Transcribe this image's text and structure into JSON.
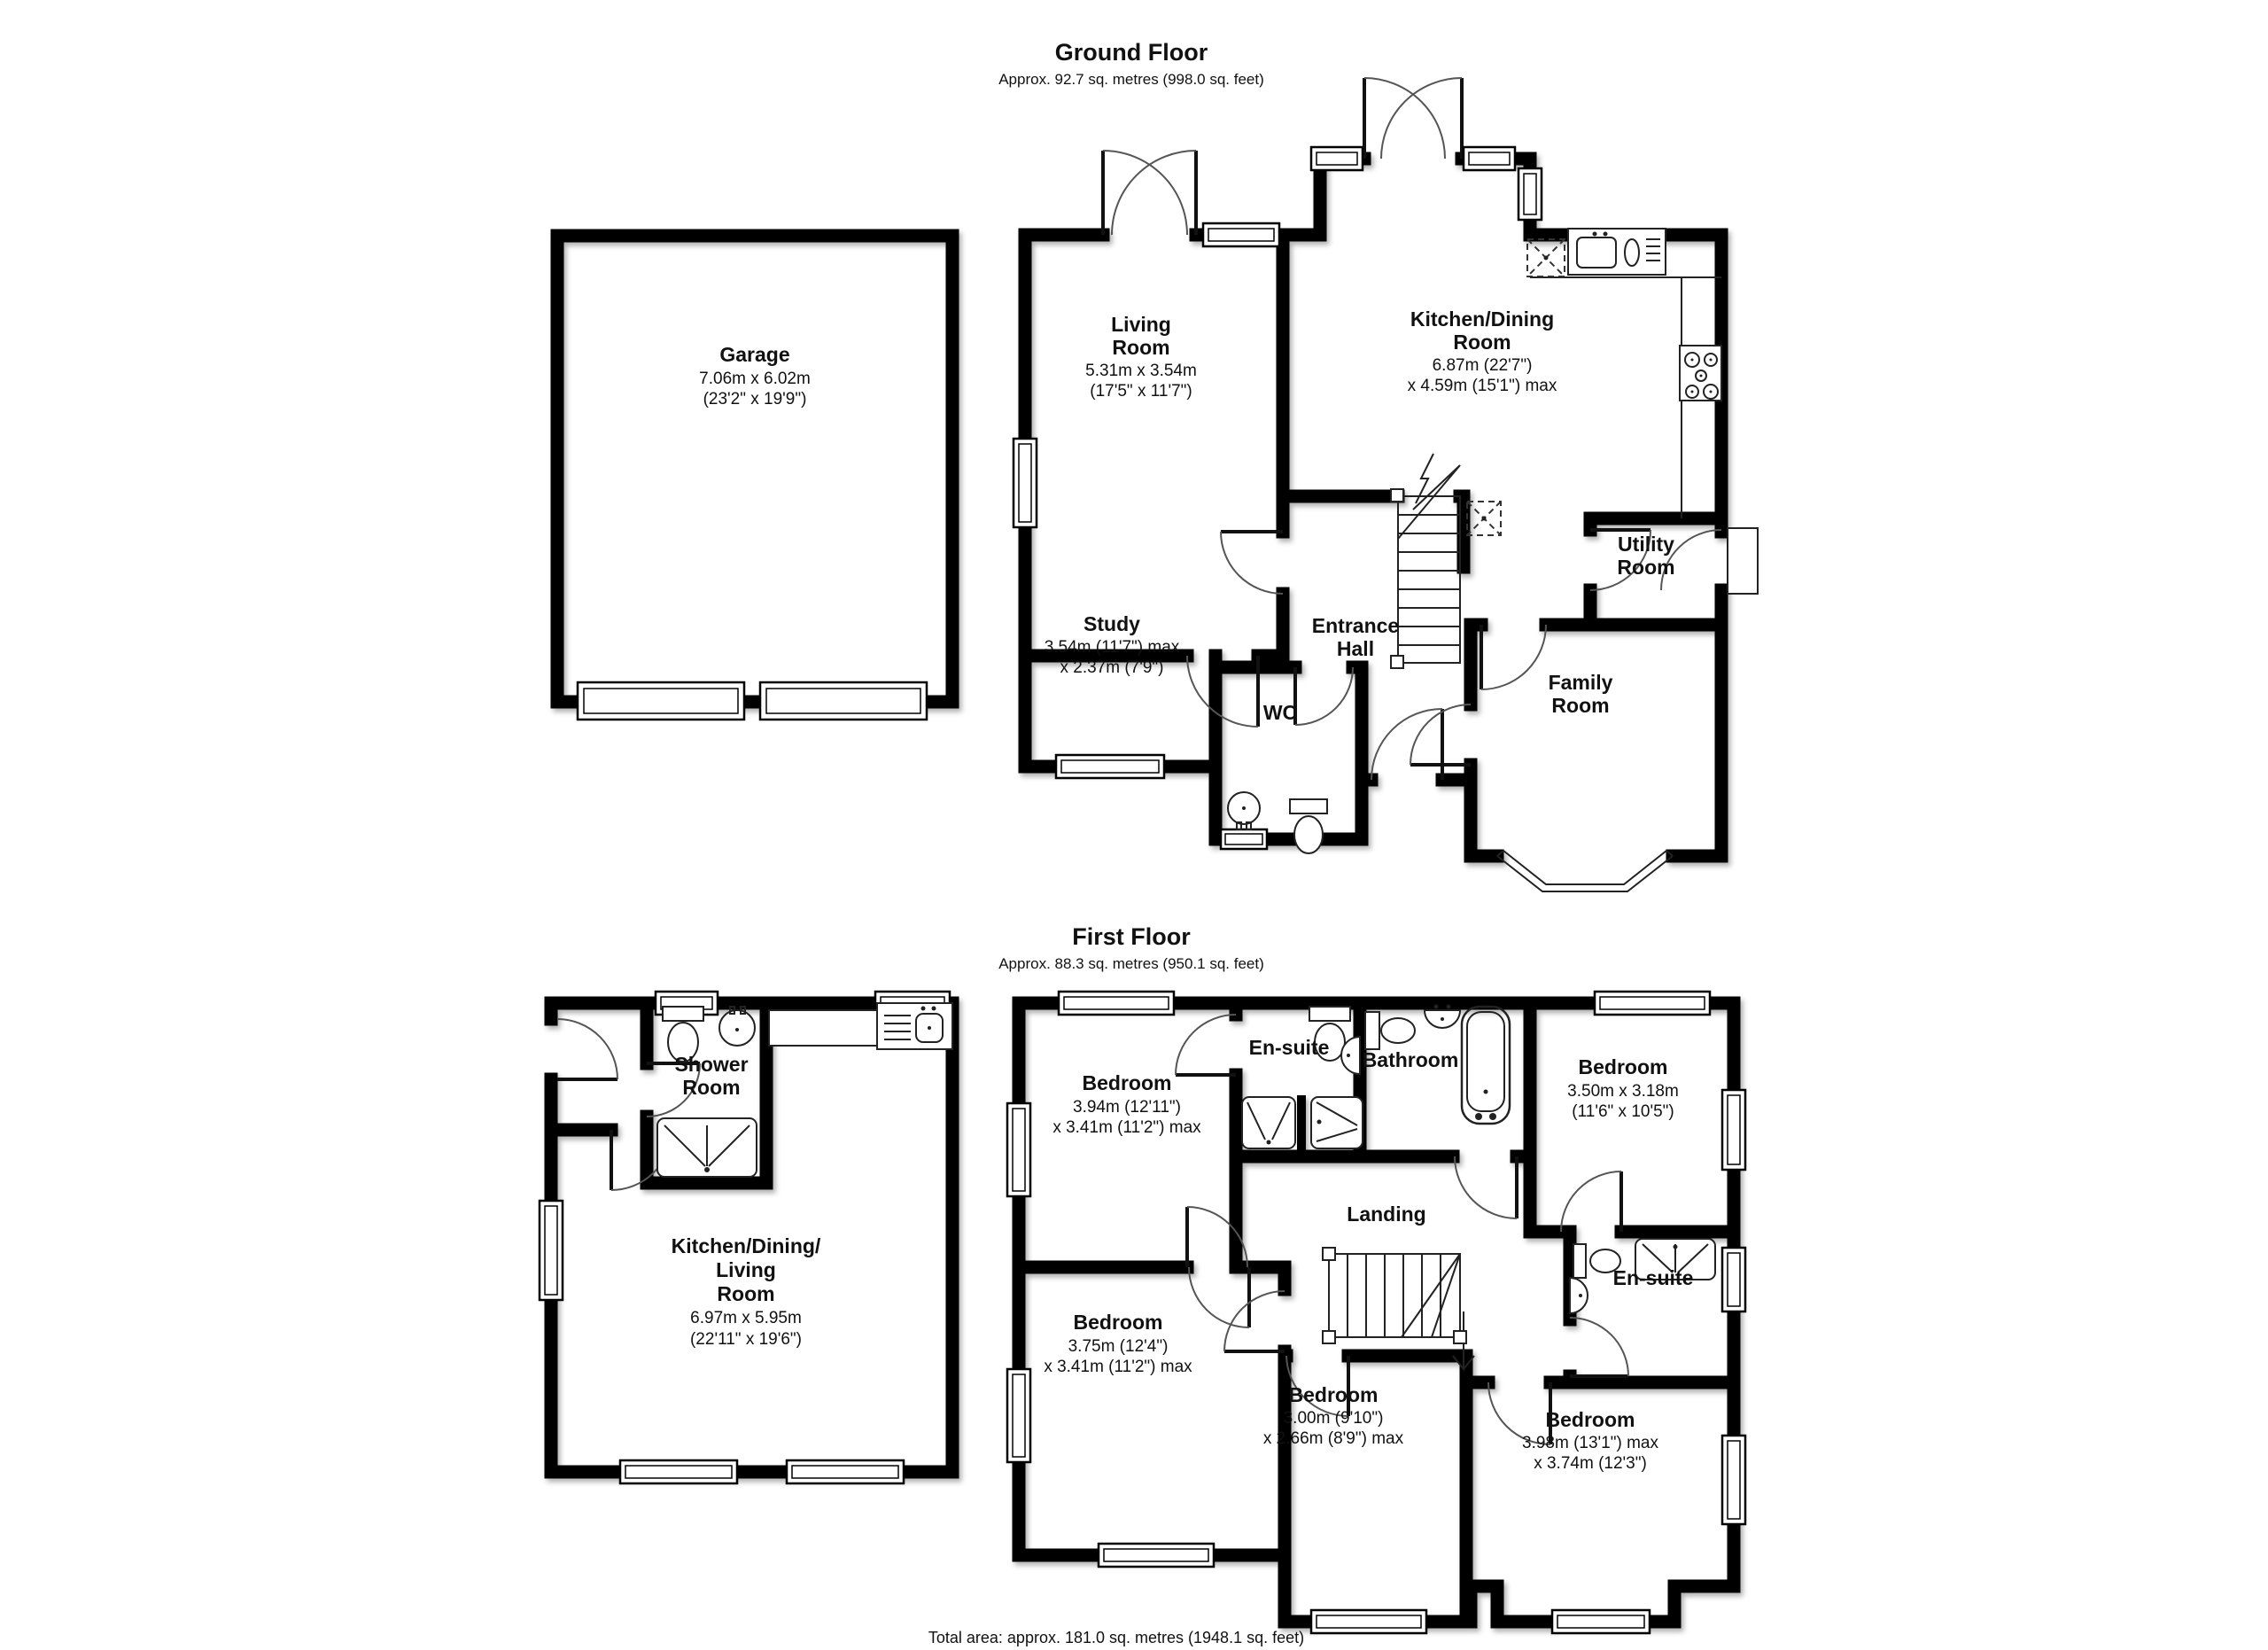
{
  "ground_floor": {
    "title": "Ground Floor",
    "subtitle": "Approx. 92.7 sq. metres (998.0 sq. feet)",
    "rooms": {
      "garage": {
        "name": "Garage",
        "metric": "7.06m x 6.02m",
        "imperial": "(23'2\" x 19'9\")"
      },
      "living_room": {
        "name1": "Living",
        "name2": "Room",
        "metric": "5.31m x 3.54m",
        "imperial": "(17'5\" x 11'7\")"
      },
      "kitchen_dining": {
        "name1": "Kitchen/Dining",
        "name2": "Room",
        "metric": "6.87m (22'7\")",
        "imperial": "x 4.59m (15'1\") max"
      },
      "study": {
        "name": "Study",
        "metric": "3.54m (11'7\") max",
        "imperial": "x 2.37m (7'9\")"
      },
      "entrance_hall": {
        "name1": "Entrance",
        "name2": "Hall"
      },
      "wc": {
        "name": "WC"
      },
      "utility_room": {
        "name1": "Utility",
        "name2": "Room"
      },
      "family_room": {
        "name1": "Family",
        "name2": "Room"
      }
    }
  },
  "first_floor": {
    "title": "First Floor",
    "subtitle": "Approx. 88.3 sq. metres (950.1 sq. feet)",
    "rooms": {
      "shower_room": {
        "name1": "Shower",
        "name2": "Room"
      },
      "kitchen_dining_living": {
        "name1": "Kitchen/Dining/",
        "name2": "Living",
        "name3": "Room",
        "metric": "6.97m x 5.95m",
        "imperial": "(22'11\" x 19'6\")"
      },
      "bedroom_1": {
        "name": "Bedroom",
        "metric": "3.94m (12'11\")",
        "imperial": "x 3.41m (11'2\") max"
      },
      "en_suite_1": {
        "name": "En-suite"
      },
      "bathroom": {
        "name": "Bathroom"
      },
      "bedroom_2": {
        "name": "Bedroom",
        "metric": "3.50m x 3.18m",
        "imperial": "(11'6\" x 10'5\")"
      },
      "landing": {
        "name": "Landing"
      },
      "bedroom_3": {
        "name": "Bedroom",
        "metric": "3.75m (12'4\")",
        "imperial": "x 3.41m (11'2\") max"
      },
      "bedroom_4": {
        "name": "Bedroom",
        "metric": "3.00m (9'10\")",
        "imperial": "x 2.66m (8'9\") max"
      },
      "en_suite_2": {
        "name": "En-suite"
      },
      "bedroom_5": {
        "name": "Bedroom",
        "metric": "3.98m (13'1\") max",
        "imperial": "x 3.74m (12'3\")"
      }
    }
  },
  "footer": {
    "total_area": "Total area: approx. 181.0 sq. metres (1948.1 sq. feet)"
  },
  "colors": {
    "wall": "#000000",
    "floor": "#ffffff",
    "text": "#111111"
  }
}
